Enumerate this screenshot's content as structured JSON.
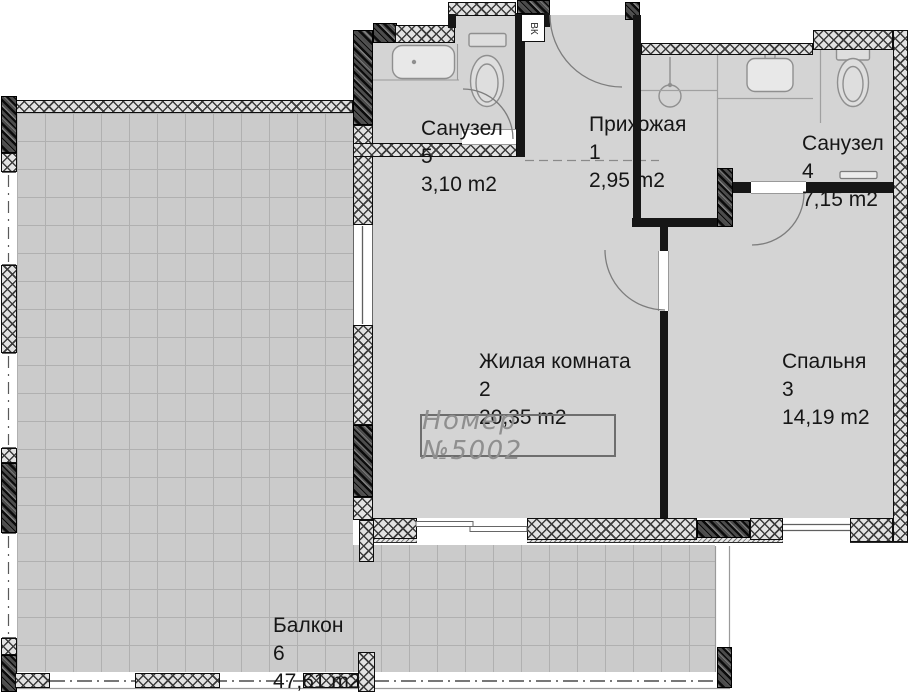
{
  "plan": {
    "rooms": [
      {
        "key": "bath5",
        "name": "Санузел",
        "number": "5",
        "area": "3,10 m2"
      },
      {
        "key": "hall",
        "name": "Прихожая",
        "number": "1",
        "area": "2,95 m2"
      },
      {
        "key": "bath4",
        "name": "Санузел",
        "number": "4",
        "area": "7,15 m2"
      },
      {
        "key": "living",
        "name": "Жилая комната",
        "number": "2",
        "area": "20,35 m2"
      },
      {
        "key": "bedroom",
        "name": "Спальня",
        "number": "3",
        "area": "14,19 m2"
      },
      {
        "key": "balcony",
        "name": "Балкон",
        "number": "6",
        "area": "47,61 m2"
      }
    ],
    "stamp": {
      "label": "Номер №5002"
    },
    "shaft": {
      "label": "ВК"
    },
    "colors": {
      "room_floor": "#d4d4d4",
      "balcony_floor": "#cbcbcb",
      "wall_dark": "#4c4c4c",
      "wall_line": "#0d0d0d",
      "stamp_gray": "#8f8f8f"
    }
  }
}
